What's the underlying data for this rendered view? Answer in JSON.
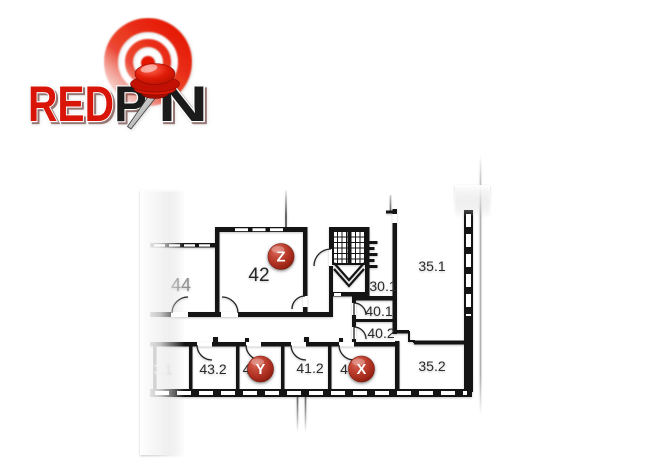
{
  "app": {
    "name": "RedPin"
  },
  "logo": {
    "red": "RED",
    "p": "P",
    "n": "N",
    "accent_color": "#d9150a",
    "ink_color": "#1b1b1b"
  },
  "floorplan": {
    "rooms": {
      "r44": "44",
      "r42": "42",
      "r35_1": "35.1",
      "r30_1": "30.1",
      "r40_1": "40.1",
      "r40_2": "40.2",
      "r43_1_partial": "3.1",
      "r43_2": "43.2",
      "r41_2": "41.2",
      "r35_2": "35.2",
      "hidden_behind_y": "4",
      "hidden_behind_x": "4"
    },
    "wall_color": "#141414",
    "room_text_color": "#2c2c2c",
    "faded_text_color": "#cacaca"
  },
  "markers": {
    "z": {
      "label": "Z"
    },
    "y": {
      "label": "Y"
    },
    "x": {
      "label": "X"
    },
    "marker_color": "#b5372a"
  }
}
